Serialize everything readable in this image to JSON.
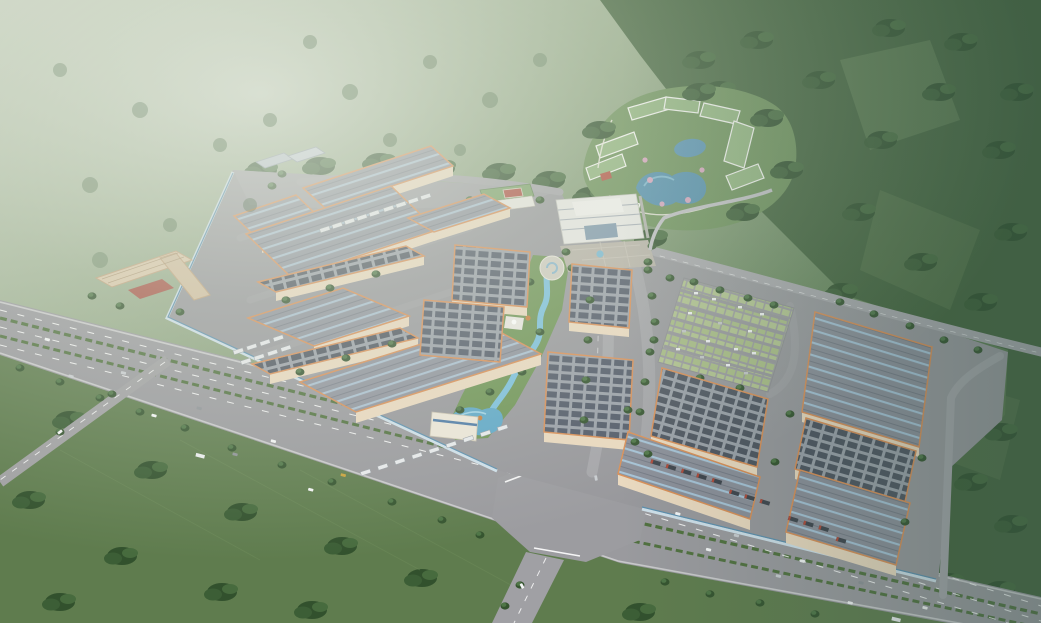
{
  "meta": {
    "title": "Aerial rendering of an industrial logistics park",
    "description": "Daytime bird's-eye 3D architectural rendering of a large walled industrial logistics campus beside a multi-lane highway. Around seventeen large warehouses with gray roofs bearing pale-blue skylight stripes or dark rooftop solar-panel grids, cream walls and orange trim, are arranged in two clusters. A landscaped corridor with a winding blue stream crosses the campus center; a white multi-story office headquarters with plaza sits at the top; a resort-style hotel complex with green roofs surrounds blue ponds on a knoll to the northeast. A grass-grid parking lot full of cars, truck loading docks with trailers, a dormitory block with red courtyard, misty green hills to the northwest, dark forested mountains to the east and farm fields with tree clusters to the southwest complete the scene.",
    "visible_text": "",
    "time_of_day": "daytime, hazy sunlight"
  },
  "palette": {
    "haze_light": "#c6d0bd",
    "hills_mid": "#7d9770",
    "forest_dark": "#36522f",
    "forest_teal_tint": "#3d5a52",
    "field_green": "#5f7c4e",
    "campus_asphalt": "#98989c",
    "highway_gray": "#9a9a9e",
    "roof_gray": "#8f939d",
    "roof_stripe_blue": "#adc6d8",
    "solar_panel_dark": "#4e5560",
    "wall_cream": "#ead9bf",
    "trim_orange": "#d98f57",
    "water_blue": "#5f9cbb",
    "stream_blue": "#7cc0dc",
    "lawn_green": "#6f9456",
    "parking_stall_green": "#b2c48f",
    "office_white": "#e7e7e3",
    "resort_roof_green": "#8fb27c",
    "courtyard_red": "#a85648",
    "truck_trailer_dark": "#3f454d",
    "truck_front_red": "#b04a3a"
  },
  "scene": {
    "regions": [
      {
        "name": "misty-hills-northwest",
        "desc": "Hazy light-green wooded hills fading into fog"
      },
      {
        "name": "forest-hills-east",
        "desc": "Dark blue-green forested mountainside with field clearings"
      },
      {
        "name": "farm-fields-southwest",
        "desc": "Green farm fields with scattered tree clusters"
      },
      {
        "name": "highway",
        "desc": "Multi-lane divided highway with green hedge medians, lane dashes, cars and trucks, plus a large paved intersection and branch roads"
      },
      {
        "name": "industrial-campus",
        "desc": "Walled logistics park on gray asphalt with internal tree-lined streets"
      },
      {
        "name": "warehouses-west-cluster",
        "desc": "Diagonal grid of large warehouses with blue-striped gray roofs and solar-panel roofs"
      },
      {
        "name": "warehouses-east-cluster",
        "desc": "Highway-aligned warehouses with skylight stripes, panel grids and dock trailers"
      },
      {
        "name": "central-stream-park",
        "desc": "Landscaped green corridor with winding blue stream, circular head plaza, sculpture terrace and pond"
      },
      {
        "name": "office-headquarters",
        "desc": "White multi-story office building with glass center and paved plaza"
      },
      {
        "name": "amenity-complex",
        "desc": "Low green-roofed canteen buildings with a red sports court"
      },
      {
        "name": "dormitory-building",
        "desc": "L-shaped tan multi-story dormitory with red courtyard"
      },
      {
        "name": "resort-hotel",
        "desc": "White slab buildings with green roofs ringing two blue ponds with pink blossom trees on a landscaped knoll"
      },
      {
        "name": "parking-lot",
        "desc": "Large grass-grid parking lot with rows of parked cars"
      },
      {
        "name": "truck-docks",
        "desc": "Rows of white and dark trailers parked at warehouse loading docks"
      }
    ]
  },
  "counts": {
    "large_warehouses": 17,
    "small_sheds": 2,
    "resort_ponds": 2,
    "highway_vehicles_approx": 22,
    "dock_trailers_approx": 34,
    "parking_rows": 7
  }
}
